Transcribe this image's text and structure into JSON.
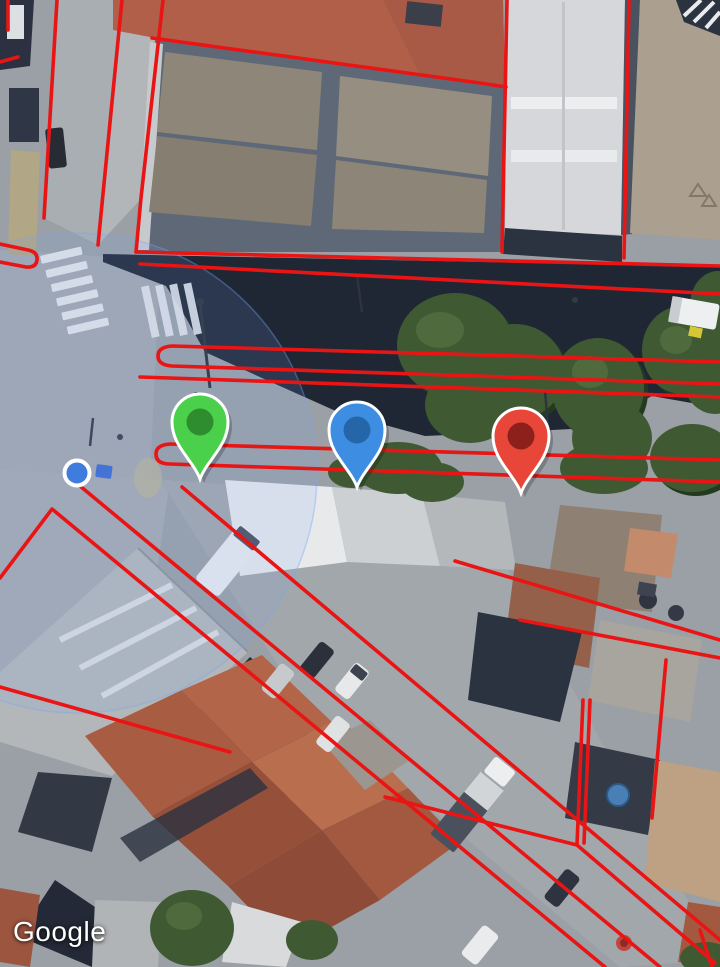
{
  "watermark": {
    "label": "Google"
  },
  "map": {
    "type": "satellite-imagery",
    "boundary_overlay_color": "#e91414",
    "markers": [
      {
        "name": "green-pin",
        "fill": "#4bd04b",
        "inner": "#2e8e2f",
        "x": 200,
        "y": 479
      },
      {
        "name": "blue-pin",
        "fill": "#3d8ee3",
        "inner": "#2566a8",
        "x": 357,
        "y": 487
      },
      {
        "name": "red-pin",
        "fill": "#e84638",
        "inner": "#8d201b",
        "x": 521,
        "y": 493
      }
    ],
    "user_location": {
      "x": 77,
      "y": 473,
      "dot_color": "#3e7ddd",
      "accuracy_radius_px": 240,
      "accuracy_fill": "rgba(120,165,245,0.14)",
      "accuracy_stroke": "rgba(120,165,245,0.38)"
    }
  }
}
